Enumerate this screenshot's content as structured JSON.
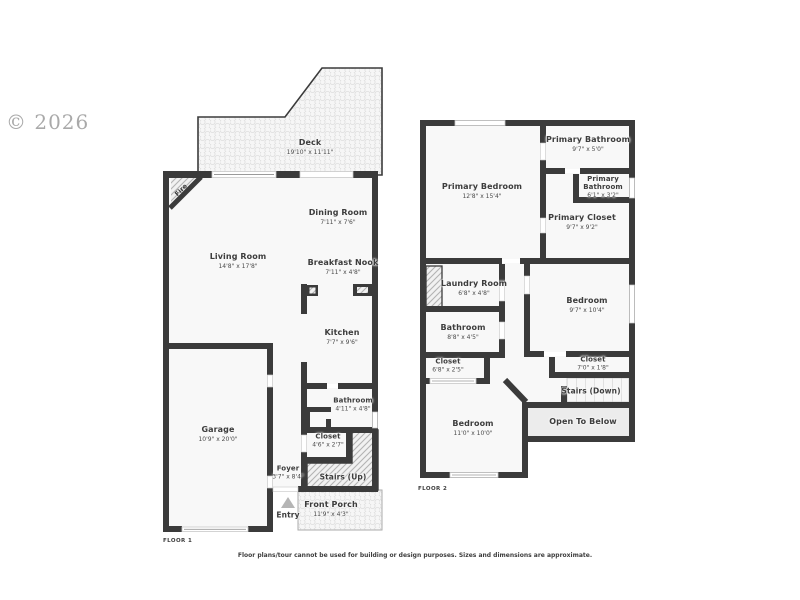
{
  "watermark": "© 2026",
  "disclaimer": "Floor plans/tour cannot be used for building or design purposes. Sizes and dimensions are approximate.",
  "floor1": {
    "label": "FLOOR 1",
    "fireplace": "Fire",
    "rooms": {
      "deck": {
        "name": "Deck",
        "dims": "19'10\" x 11'11\""
      },
      "dining": {
        "name": "Dining Room",
        "dims": "7'11\" x 7'6\""
      },
      "living": {
        "name": "Living Room",
        "dims": "14'8\" x 17'8\""
      },
      "breakfast": {
        "name": "Breakfast Nook",
        "dims": "7'11\" x 4'8\""
      },
      "kitchen": {
        "name": "Kitchen",
        "dims": "7'7\" x 9'6\""
      },
      "bathroom": {
        "name": "Bathroom",
        "dims": "4'11\" x 4'8\""
      },
      "closet": {
        "name": "Closet",
        "dims": "4'6\" x 2'7\""
      },
      "garage": {
        "name": "Garage",
        "dims": "10'9\" x 20'0\""
      },
      "foyer": {
        "name": "Foyer",
        "dims": "3'7\" x 8'4\""
      },
      "stairs": {
        "name": "Stairs (Up)"
      },
      "entry": {
        "name": "Entry"
      },
      "porch": {
        "name": "Front Porch",
        "dims": "11'9\" x 4'3\""
      }
    }
  },
  "floor2": {
    "label": "FLOOR 2",
    "rooms": {
      "primary_bedroom": {
        "name": "Primary Bedroom",
        "dims": "12'8\" x 15'4\""
      },
      "primary_bathroom": {
        "name": "Primary Bathroom",
        "dims": "9'7\" x 5'0\""
      },
      "primary_bathroom_2": {
        "name": "Primary Bathroom",
        "dims": "6'1\" x 3'2\""
      },
      "primary_closet": {
        "name": "Primary Closet",
        "dims": "9'7\" x 9'2\""
      },
      "laundry": {
        "name": "Laundry Room",
        "dims": "6'8\" x 4'8\""
      },
      "bathroom": {
        "name": "Bathroom",
        "dims": "8'8\" x 4'5\""
      },
      "closet_hall": {
        "name": "Closet",
        "dims": "6'8\" x 2'5\""
      },
      "bedroom_right": {
        "name": "Bedroom",
        "dims": "9'7\" x 10'4\""
      },
      "closet_right": {
        "name": "Closet",
        "dims": "7'0\" x 1'8\""
      },
      "stairs": {
        "name": "Stairs (Down)"
      },
      "open_to_below": {
        "name": "Open To Below"
      },
      "bedroom_lower": {
        "name": "Bedroom",
        "dims": "11'0\" x 10'0\""
      }
    }
  }
}
